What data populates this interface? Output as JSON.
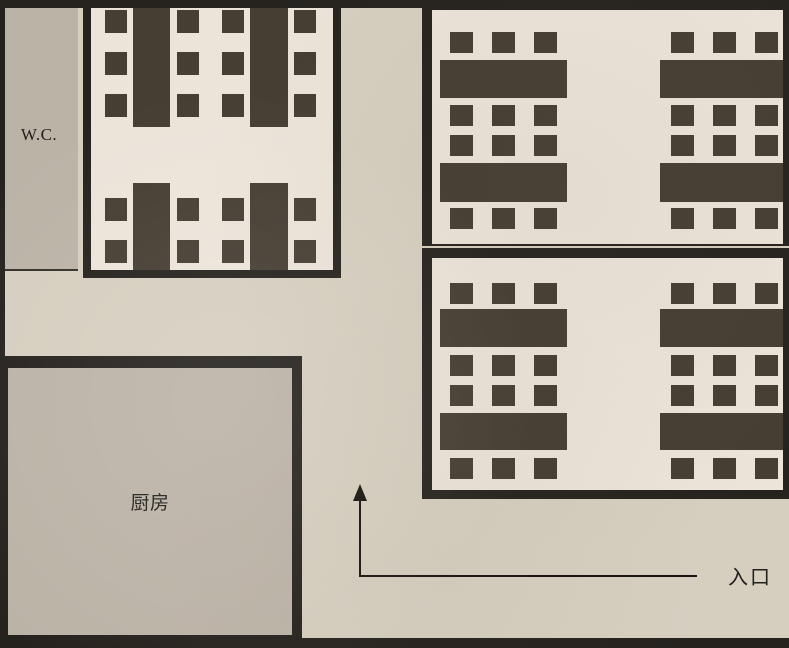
{
  "canvas": {
    "width": 789,
    "height": 648
  },
  "colors": {
    "wall": "#26231f",
    "furniture": "#463e33",
    "dining_floor": "#ece4d9",
    "service_floor": "#bcb3a7",
    "corridor_floor": "#d6cfc0",
    "ink": "#21201c",
    "arrow": "#17140f"
  },
  "labels": {
    "wc": "W.C.",
    "kitchen": "厨房",
    "entrance": "入口"
  },
  "furniture": {
    "tables": [
      {
        "x": 133,
        "y": 8,
        "w": 37,
        "h": 119
      },
      {
        "x": 250,
        "y": 8,
        "w": 38,
        "h": 119
      },
      {
        "x": 133,
        "y": 183,
        "w": 37,
        "h": 87
      },
      {
        "x": 250,
        "y": 183,
        "w": 38,
        "h": 87
      },
      {
        "x": 440,
        "y": 60,
        "w": 127,
        "h": 38
      },
      {
        "x": 660,
        "y": 60,
        "w": 123,
        "h": 38
      },
      {
        "x": 440,
        "y": 163,
        "w": 127,
        "h": 39
      },
      {
        "x": 660,
        "y": 163,
        "w": 123,
        "h": 39
      },
      {
        "x": 440,
        "y": 309,
        "w": 127,
        "h": 38
      },
      {
        "x": 660,
        "y": 309,
        "w": 123,
        "h": 38
      },
      {
        "x": 440,
        "y": 413,
        "w": 127,
        "h": 37
      },
      {
        "x": 660,
        "y": 413,
        "w": 123,
        "h": 37
      }
    ],
    "chair_grids": [
      {
        "cols": [
          105,
          177,
          222,
          294
        ],
        "rows": [
          10,
          52,
          94
        ],
        "w": 22,
        "h": 23
      },
      {
        "cols": [
          105,
          177,
          222,
          294
        ],
        "rows": [
          198,
          240
        ],
        "w": 22,
        "h": 23
      },
      {
        "cols": [
          450,
          492,
          534
        ],
        "rows": [
          32,
          105,
          135,
          208
        ],
        "w": 23,
        "h": 21
      },
      {
        "cols": [
          671,
          713,
          755
        ],
        "rows": [
          32,
          105,
          135,
          208
        ],
        "w": 23,
        "h": 21
      },
      {
        "cols": [
          450,
          492,
          534
        ],
        "rows": [
          283,
          355,
          385,
          458
        ],
        "w": 23,
        "h": 21
      },
      {
        "cols": [
          671,
          713,
          755
        ],
        "rows": [
          283,
          355,
          385,
          458
        ],
        "w": 23,
        "h": 21
      }
    ]
  }
}
